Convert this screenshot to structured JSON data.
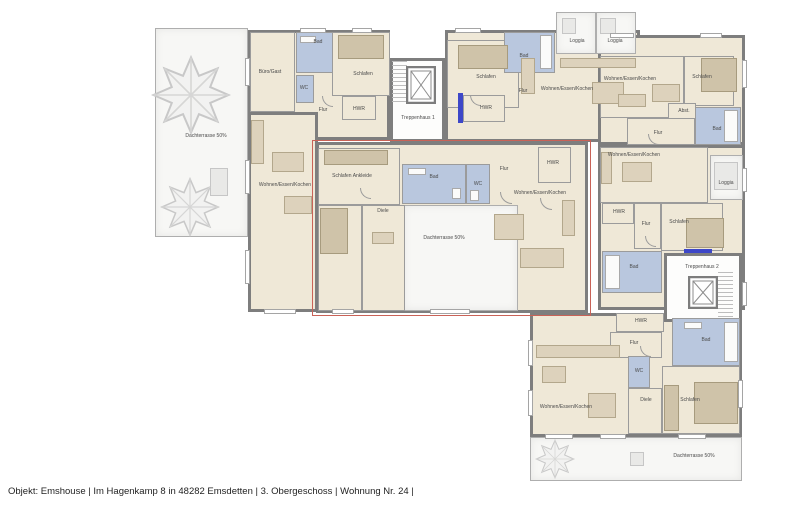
{
  "meta": {
    "footer": "Objekt: Emshouse | Im Hagenkamp 8 in 48282 Emsdetten | 3. Obergeschoss | Wohnung Nr. 24 |"
  },
  "colors": {
    "wall": "#7e7e7e",
    "floor": "#efe8d7",
    "bath_blue": "#b9c7de",
    "terrace": "#f7f7f5",
    "highlight_red": "#c96257",
    "accent_blue": "#3d47c8"
  },
  "plan": {
    "highlight": {
      "x": 312,
      "y": 140,
      "w": 277,
      "h": 174
    },
    "regions": [
      {
        "t": "terrace",
        "x": 155,
        "y": 28,
        "w": 93,
        "h": 209
      },
      {
        "t": "floor",
        "x": 248,
        "y": 30,
        "w": 142,
        "h": 110
      },
      {
        "t": "floor",
        "x": 248,
        "y": 112,
        "w": 70,
        "h": 200
      },
      {
        "t": "floor",
        "x": 445,
        "y": 30,
        "w": 195,
        "h": 112
      },
      {
        "t": "floor",
        "x": 598,
        "y": 35,
        "w": 147,
        "h": 110
      },
      {
        "t": "floor",
        "x": 598,
        "y": 145,
        "w": 147,
        "h": 165
      },
      {
        "t": "floor",
        "x": 316,
        "y": 142,
        "w": 272,
        "h": 171
      },
      {
        "t": "floor",
        "x": 530,
        "y": 313,
        "w": 212,
        "h": 124
      },
      {
        "t": "stair",
        "x": 390,
        "y": 58,
        "w": 55,
        "h": 84
      },
      {
        "t": "terrace",
        "x": 556,
        "y": 12,
        "w": 40,
        "h": 42
      },
      {
        "t": "terrace",
        "x": 596,
        "y": 12,
        "w": 40,
        "h": 42
      },
      {
        "t": "terrace",
        "x": 710,
        "y": 155,
        "w": 33,
        "h": 45
      },
      {
        "t": "stair",
        "x": 664,
        "y": 253,
        "w": 78,
        "h": 69
      },
      {
        "t": "terrace",
        "x": 403,
        "y": 205,
        "w": 115,
        "h": 106
      },
      {
        "t": "terrace",
        "x": 530,
        "y": 437,
        "w": 212,
        "h": 44
      }
    ],
    "rooms": [
      {
        "t": "bath",
        "x": 296,
        "y": 32,
        "w": 47,
        "h": 41
      },
      {
        "t": "bath",
        "x": 296,
        "y": 75,
        "w": 18,
        "h": 28
      },
      {
        "t": "floor",
        "x": 250,
        "y": 32,
        "w": 45,
        "h": 80
      },
      {
        "t": "floor",
        "x": 332,
        "y": 32,
        "w": 58,
        "h": 64
      },
      {
        "t": "floor",
        "x": 342,
        "y": 96,
        "w": 34,
        "h": 24
      },
      {
        "t": "floor",
        "x": 447,
        "y": 40,
        "w": 72,
        "h": 68
      },
      {
        "t": "bath",
        "x": 504,
        "y": 32,
        "w": 51,
        "h": 41
      },
      {
        "t": "floor",
        "x": 463,
        "y": 95,
        "w": 42,
        "h": 27
      },
      {
        "t": "floor",
        "x": 600,
        "y": 56,
        "w": 84,
        "h": 62
      },
      {
        "t": "floor",
        "x": 684,
        "y": 56,
        "w": 50,
        "h": 50
      },
      {
        "t": "floor",
        "x": 668,
        "y": 103,
        "w": 28,
        "h": 17
      },
      {
        "t": "bath",
        "x": 695,
        "y": 107,
        "w": 46,
        "h": 38
      },
      {
        "t": "floor",
        "x": 627,
        "y": 118,
        "w": 68,
        "h": 27
      },
      {
        "t": "floor",
        "x": 600,
        "y": 147,
        "w": 108,
        "h": 56
      },
      {
        "t": "floor",
        "x": 602,
        "y": 203,
        "w": 32,
        "h": 21
      },
      {
        "t": "floor",
        "x": 634,
        "y": 203,
        "w": 27,
        "h": 46
      },
      {
        "t": "floor",
        "x": 661,
        "y": 203,
        "w": 62,
        "h": 48
      },
      {
        "t": "bath",
        "x": 602,
        "y": 251,
        "w": 60,
        "h": 42
      },
      {
        "t": "floor",
        "x": 318,
        "y": 148,
        "w": 82,
        "h": 57
      },
      {
        "t": "floor",
        "x": 318,
        "y": 205,
        "w": 44,
        "h": 106
      },
      {
        "t": "floor",
        "x": 362,
        "y": 205,
        "w": 43,
        "h": 106
      },
      {
        "t": "bath",
        "x": 402,
        "y": 164,
        "w": 64,
        "h": 40
      },
      {
        "t": "bath",
        "x": 466,
        "y": 164,
        "w": 24,
        "h": 40
      },
      {
        "t": "floor",
        "x": 538,
        "y": 147,
        "w": 33,
        "h": 36
      },
      {
        "t": "floor",
        "x": 616,
        "y": 313,
        "w": 48,
        "h": 19
      },
      {
        "t": "floor",
        "x": 610,
        "y": 332,
        "w": 52,
        "h": 26
      },
      {
        "t": "bath",
        "x": 672,
        "y": 318,
        "w": 68,
        "h": 48
      },
      {
        "t": "bath",
        "x": 628,
        "y": 356,
        "w": 22,
        "h": 32
      },
      {
        "t": "floor",
        "x": 628,
        "y": 388,
        "w": 34,
        "h": 46
      },
      {
        "t": "floor",
        "x": 662,
        "y": 366,
        "w": 78,
        "h": 68
      }
    ],
    "furniture": [
      {
        "v": "dark",
        "x": 338,
        "y": 35,
        "w": 46,
        "h": 24
      },
      {
        "v": "",
        "x": 251,
        "y": 120,
        "w": 13,
        "h": 44
      },
      {
        "v": "",
        "x": 272,
        "y": 152,
        "w": 32,
        "h": 20
      },
      {
        "v": "",
        "x": 284,
        "y": 196,
        "w": 28,
        "h": 18
      },
      {
        "v": "white",
        "x": 300,
        "y": 36,
        "w": 16,
        "h": 7
      },
      {
        "v": "dark",
        "x": 458,
        "y": 45,
        "w": 50,
        "h": 24
      },
      {
        "v": "",
        "x": 521,
        "y": 58,
        "w": 14,
        "h": 36
      },
      {
        "v": "",
        "x": 560,
        "y": 58,
        "w": 76,
        "h": 10
      },
      {
        "v": "",
        "x": 592,
        "y": 82,
        "w": 32,
        "h": 22
      },
      {
        "v": "white",
        "x": 540,
        "y": 35,
        "w": 12,
        "h": 34
      },
      {
        "v": "",
        "x": 652,
        "y": 84,
        "w": 28,
        "h": 18
      },
      {
        "v": "",
        "x": 618,
        "y": 94,
        "w": 28,
        "h": 13
      },
      {
        "v": "dark",
        "x": 701,
        "y": 58,
        "w": 36,
        "h": 34
      },
      {
        "v": "white",
        "x": 724,
        "y": 110,
        "w": 14,
        "h": 32
      },
      {
        "v": "",
        "x": 622,
        "y": 162,
        "w": 30,
        "h": 20
      },
      {
        "v": "",
        "x": 601,
        "y": 152,
        "w": 11,
        "h": 32
      },
      {
        "v": "dark",
        "x": 686,
        "y": 218,
        "w": 38,
        "h": 30
      },
      {
        "v": "white",
        "x": 605,
        "y": 255,
        "w": 15,
        "h": 34
      },
      {
        "v": "dark",
        "x": 324,
        "y": 150,
        "w": 64,
        "h": 15
      },
      {
        "v": "dark",
        "x": 320,
        "y": 208,
        "w": 28,
        "h": 46
      },
      {
        "v": "",
        "x": 372,
        "y": 232,
        "w": 22,
        "h": 12
      },
      {
        "v": "",
        "x": 494,
        "y": 214,
        "w": 30,
        "h": 26
      },
      {
        "v": "",
        "x": 562,
        "y": 200,
        "w": 13,
        "h": 36
      },
      {
        "v": "",
        "x": 520,
        "y": 248,
        "w": 44,
        "h": 20
      },
      {
        "v": "white",
        "x": 408,
        "y": 168,
        "w": 18,
        "h": 7
      },
      {
        "v": "white",
        "x": 452,
        "y": 188,
        "w": 9,
        "h": 11
      },
      {
        "v": "white",
        "x": 470,
        "y": 190,
        "w": 9,
        "h": 11
      },
      {
        "v": "",
        "x": 536,
        "y": 345,
        "w": 84,
        "h": 13
      },
      {
        "v": "",
        "x": 542,
        "y": 366,
        "w": 24,
        "h": 17
      },
      {
        "v": "",
        "x": 588,
        "y": 393,
        "w": 28,
        "h": 25
      },
      {
        "v": "dark",
        "x": 694,
        "y": 382,
        "w": 44,
        "h": 42
      },
      {
        "v": "dark",
        "x": 664,
        "y": 385,
        "w": 15,
        "h": 46
      },
      {
        "v": "white",
        "x": 724,
        "y": 322,
        "w": 14,
        "h": 40
      },
      {
        "v": "white",
        "x": 684,
        "y": 322,
        "w": 18,
        "h": 7
      },
      {
        "v": "gray",
        "x": 562,
        "y": 18,
        "w": 14,
        "h": 16
      },
      {
        "v": "gray",
        "x": 600,
        "y": 18,
        "w": 16,
        "h": 16
      },
      {
        "v": "gray",
        "x": 714,
        "y": 162,
        "w": 24,
        "h": 28
      },
      {
        "v": "gray",
        "x": 169,
        "y": 87,
        "w": 22,
        "h": 14
      },
      {
        "v": "gray",
        "x": 210,
        "y": 168,
        "w": 18,
        "h": 28
      },
      {
        "v": "gray",
        "x": 630,
        "y": 452,
        "w": 14,
        "h": 14
      }
    ],
    "windows": [
      [
        300,
        28,
        26,
        5
      ],
      [
        352,
        28,
        20,
        5
      ],
      [
        245,
        58,
        5,
        28
      ],
      [
        245,
        160,
        5,
        34
      ],
      [
        245,
        250,
        5,
        34
      ],
      [
        264,
        309,
        32,
        5
      ],
      [
        455,
        28,
        26,
        5
      ],
      [
        610,
        33,
        24,
        5
      ],
      [
        700,
        33,
        22,
        5
      ],
      [
        742,
        60,
        5,
        28
      ],
      [
        742,
        168,
        5,
        24
      ],
      [
        742,
        282,
        5,
        24
      ],
      [
        430,
        309,
        40,
        5
      ],
      [
        332,
        309,
        22,
        5
      ],
      [
        545,
        434,
        28,
        5
      ],
      [
        600,
        434,
        26,
        5
      ],
      [
        678,
        434,
        28,
        5
      ],
      [
        738,
        380,
        5,
        28
      ],
      [
        528,
        340,
        5,
        26
      ],
      [
        528,
        390,
        5,
        26
      ]
    ],
    "accents": [
      [
        458,
        93,
        5,
        30
      ],
      [
        684,
        249,
        28,
        4
      ]
    ],
    "doors": [
      [
        322,
        96,
        11,
        11
      ],
      [
        470,
        95,
        11,
        11
      ],
      [
        500,
        192,
        12,
        12
      ],
      [
        648,
        134,
        11,
        11
      ],
      [
        645,
        236,
        11,
        11
      ],
      [
        640,
        346,
        11,
        11
      ],
      [
        360,
        188,
        11,
        11
      ],
      [
        540,
        198,
        12,
        12
      ]
    ],
    "trees": [
      [
        191,
        95,
        40
      ],
      [
        190,
        207,
        30
      ],
      [
        555,
        459,
        20
      ]
    ],
    "elevators": [
      [
        406,
        66,
        30,
        38
      ],
      [
        688,
        276,
        30,
        33
      ]
    ],
    "stairs": [
      [
        392,
        61,
        15,
        44
      ],
      [
        718,
        272,
        15,
        46
      ]
    ],
    "labels": [
      {
        "t": "Dachterrasse 50%",
        "x": 206,
        "y": 136
      },
      {
        "t": "Büro/Gast",
        "x": 270,
        "y": 72
      },
      {
        "t": "Bad",
        "x": 318,
        "y": 42
      },
      {
        "t": "WC",
        "x": 304,
        "y": 88
      },
      {
        "t": "Schlafen",
        "x": 363,
        "y": 74
      },
      {
        "t": "HWR",
        "x": 359,
        "y": 109
      },
      {
        "t": "Flur",
        "x": 323,
        "y": 110
      },
      {
        "t": "Wohnen/Essen/Kochen",
        "x": 285,
        "y": 185
      },
      {
        "t": "Treppenhaus 1",
        "x": 418,
        "y": 118
      },
      {
        "t": "Schlafen",
        "x": 486,
        "y": 77
      },
      {
        "t": "Bad",
        "x": 524,
        "y": 56
      },
      {
        "t": "Flur",
        "x": 523,
        "y": 91
      },
      {
        "t": "HWR",
        "x": 486,
        "y": 108
      },
      {
        "t": "Wohnen/Essen/Kochen",
        "x": 567,
        "y": 89
      },
      {
        "t": "Loggia",
        "x": 577,
        "y": 41
      },
      {
        "t": "Loggia",
        "x": 615,
        "y": 41
      },
      {
        "t": "Wohnen/Essen/Kochen",
        "x": 630,
        "y": 79
      },
      {
        "t": "Schlafen",
        "x": 702,
        "y": 77
      },
      {
        "t": "Abst.",
        "x": 684,
        "y": 111
      },
      {
        "t": "Bad",
        "x": 717,
        "y": 129
      },
      {
        "t": "Flur",
        "x": 658,
        "y": 133
      },
      {
        "t": "Wohnen/Essen/Kochen",
        "x": 634,
        "y": 155
      },
      {
        "t": "Loggia",
        "x": 726,
        "y": 183
      },
      {
        "t": "HWR",
        "x": 619,
        "y": 212
      },
      {
        "t": "Flur",
        "x": 646,
        "y": 224
      },
      {
        "t": "Schlafen",
        "x": 679,
        "y": 222
      },
      {
        "t": "Bad",
        "x": 634,
        "y": 267
      },
      {
        "t": "Treppenhaus 2",
        "x": 702,
        "y": 267
      },
      {
        "t": "Schlafen Ankleide",
        "x": 352,
        "y": 176
      },
      {
        "t": "Diele",
        "x": 383,
        "y": 211
      },
      {
        "t": "Bad",
        "x": 434,
        "y": 177
      },
      {
        "t": "WC",
        "x": 478,
        "y": 184
      },
      {
        "t": "Flur",
        "x": 504,
        "y": 169
      },
      {
        "t": "HWR",
        "x": 553,
        "y": 163
      },
      {
        "t": "Wohnen/Essen/Kochen",
        "x": 540,
        "y": 193
      },
      {
        "t": "Dachterrasse 50%",
        "x": 444,
        "y": 238
      },
      {
        "t": "HWR",
        "x": 641,
        "y": 321
      },
      {
        "t": "Flur",
        "x": 634,
        "y": 343
      },
      {
        "t": "Bad",
        "x": 706,
        "y": 340
      },
      {
        "t": "WC",
        "x": 639,
        "y": 371
      },
      {
        "t": "Diele",
        "x": 646,
        "y": 400
      },
      {
        "t": "Schlafen",
        "x": 690,
        "y": 400
      },
      {
        "t": "Wohnen/Essen/Kochen",
        "x": 566,
        "y": 407
      },
      {
        "t": "Dachterrasse 50%",
        "x": 694,
        "y": 456
      }
    ]
  }
}
